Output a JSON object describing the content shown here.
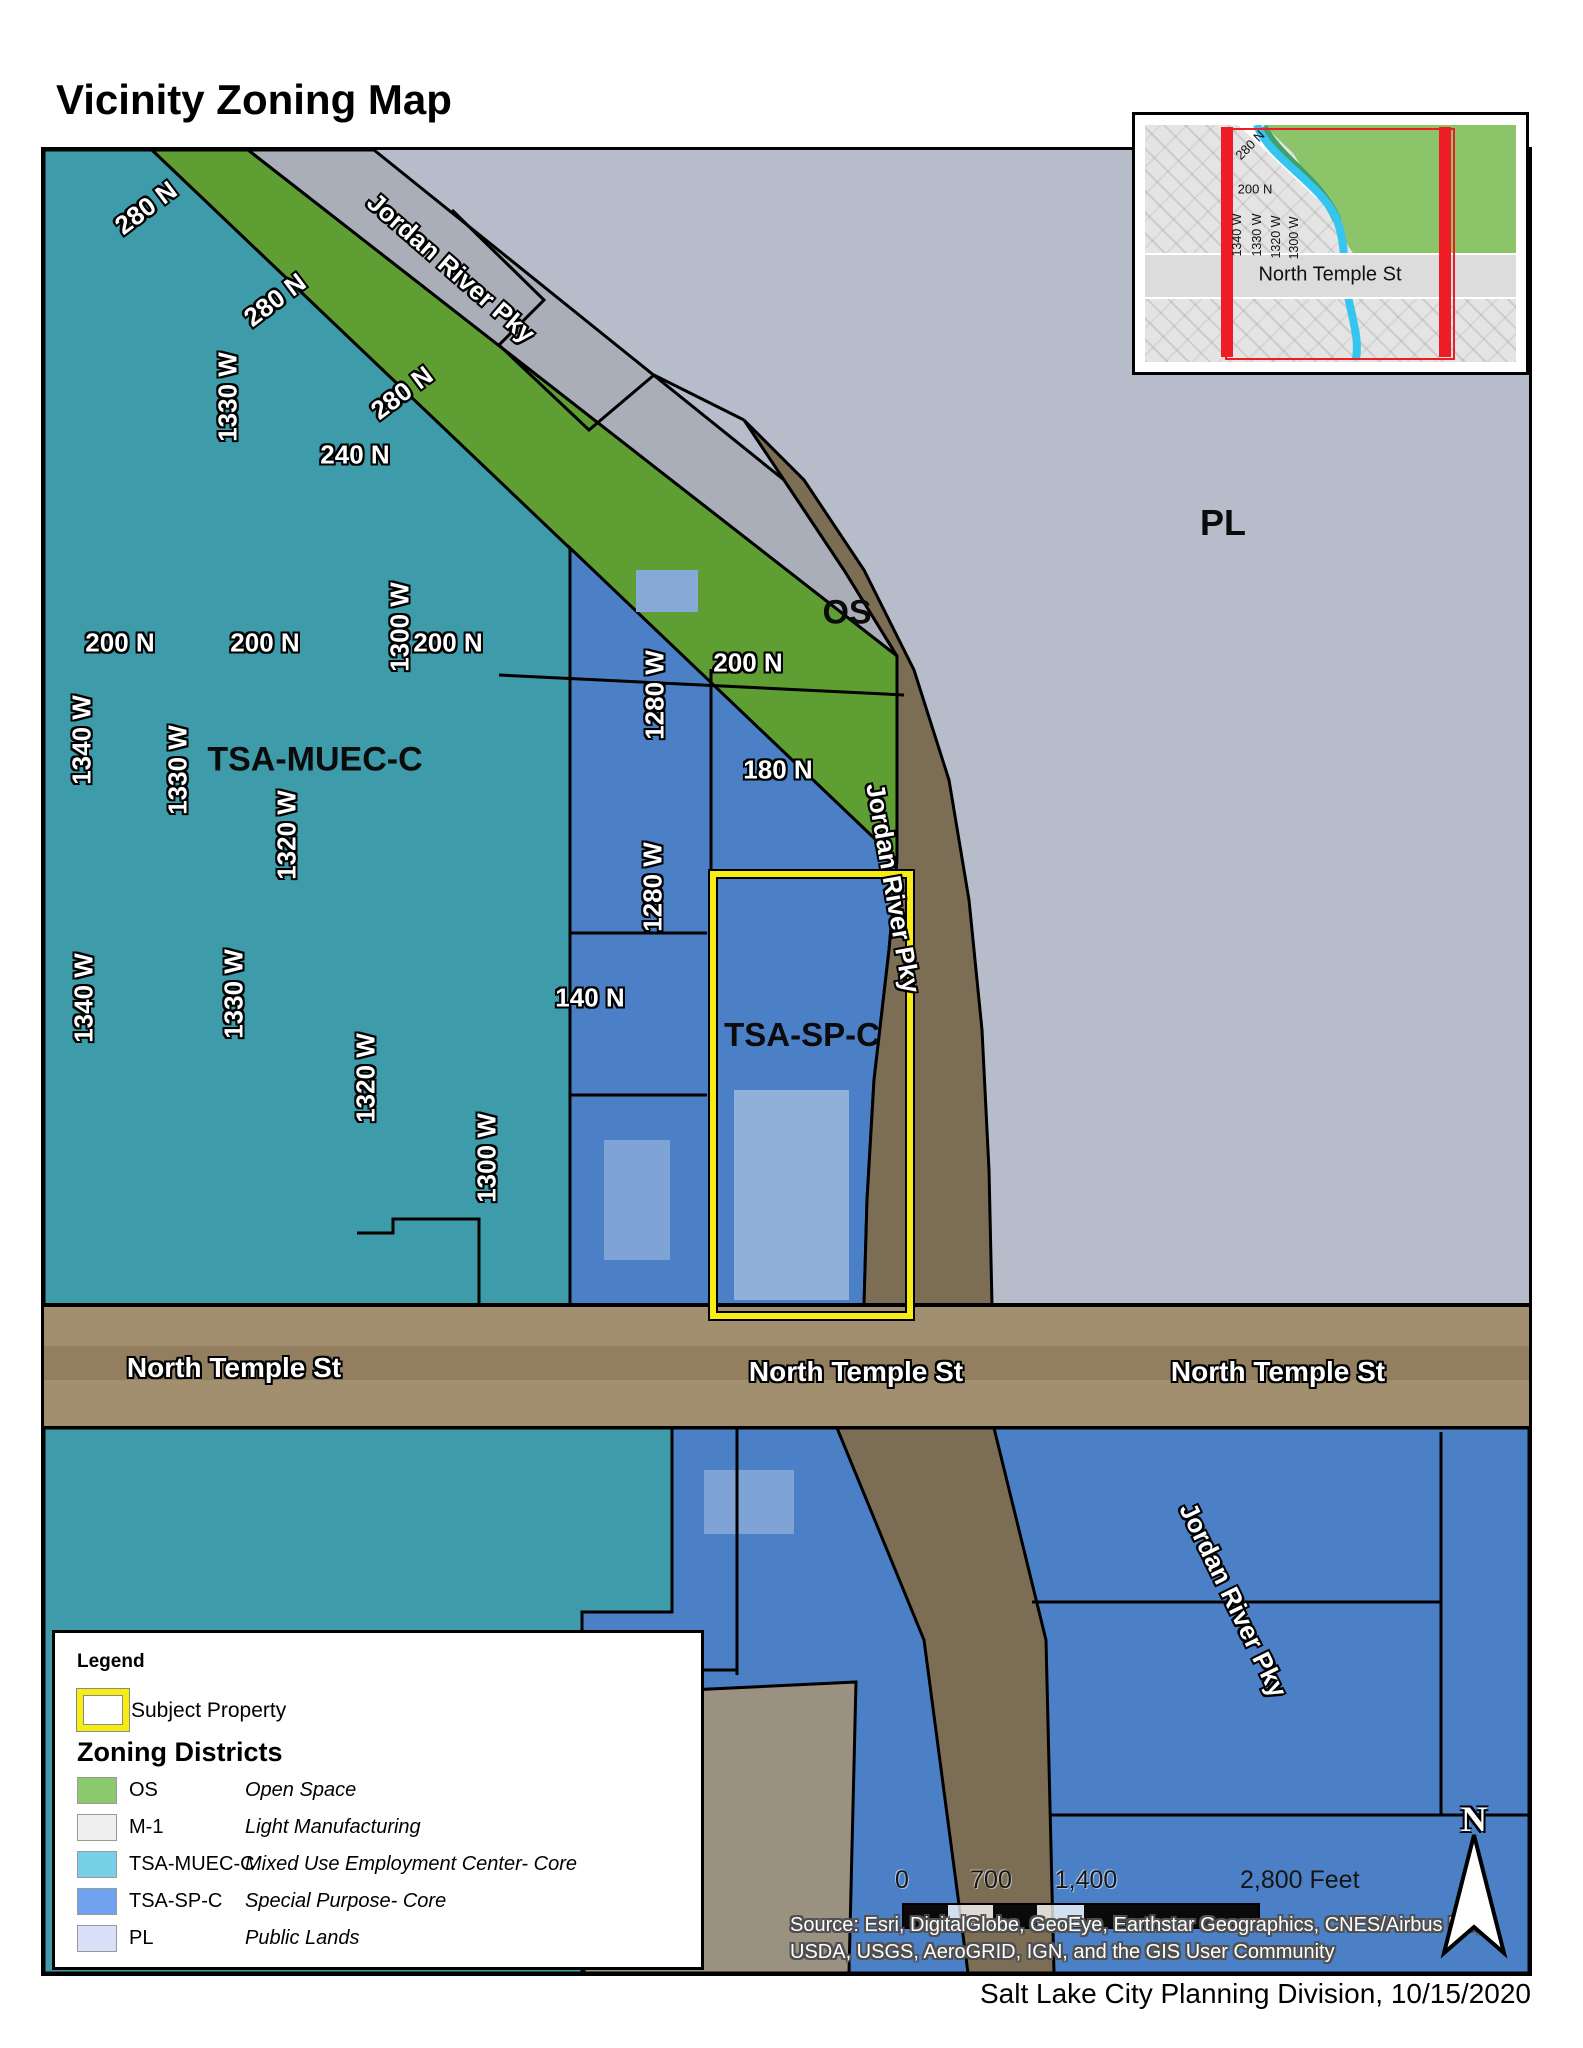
{
  "title": "Vicinity Zoning Map",
  "labels": {
    "n280": "280 N",
    "n240": "240 N",
    "n200": "200 N",
    "n180": "180 N",
    "n140": "140 N",
    "w1340": "1340 W",
    "w1330": "1330 W",
    "w1320": "1320 W",
    "w1300": "1300 W",
    "w1280": "1280 W",
    "jordan": "Jordan River Pky",
    "north_temple": "North Temple St",
    "os": "OS",
    "pl": "PL",
    "tsa_muec": "TSA-MUEC-C",
    "tsa_sp": "TSA-SP-C"
  },
  "legend": {
    "title": "Legend",
    "subject_label": "Subject Property",
    "districts_title": "Zoning Districts",
    "entries": [
      {
        "code": "OS",
        "desc": "Open Space",
        "color": "#8CC86D"
      },
      {
        "code": "M-1",
        "desc": "Light Manufacturing",
        "color": "#EFEFEF"
      },
      {
        "code": "TSA-MUEC-C",
        "desc": "Mixed Use Employment Center- Core",
        "color": "#76D1E8"
      },
      {
        "code": "TSA-SP-C",
        "desc": "Special Purpose- Core",
        "color": "#6FA3F0"
      },
      {
        "code": "PL",
        "desc": "Public Lands",
        "color": "#D9DFF7"
      }
    ]
  },
  "scalebar": {
    "tick0": "0",
    "tick700": "700",
    "tick1400": "1,400",
    "end_label": "2,800 Feet"
  },
  "source": {
    "line1": "Source: Esri, DigitalGlobe, GeoEye, Earthstar Geographics, CNES/Airbus DS,",
    "line2": "USDA, USGS, AeroGRID, IGN, and the GIS User Community"
  },
  "credit": "Salt Lake City Planning Division, 10/15/2020",
  "north_letter": "N",
  "colors": {
    "zone_os_map": "#5E9E33",
    "zone_muec_map": "#3E9BA9",
    "zone_sp_map": "#4C80C6",
    "zone_pl_map": "#B6BCC9",
    "river_corridor": "#7B6E55",
    "street_band": "#A28F70",
    "subject_outline": "#F7EC13",
    "inset_red": "#EE1C25",
    "inset_river": "#35C5F0",
    "inset_green": "#8CC46A"
  }
}
